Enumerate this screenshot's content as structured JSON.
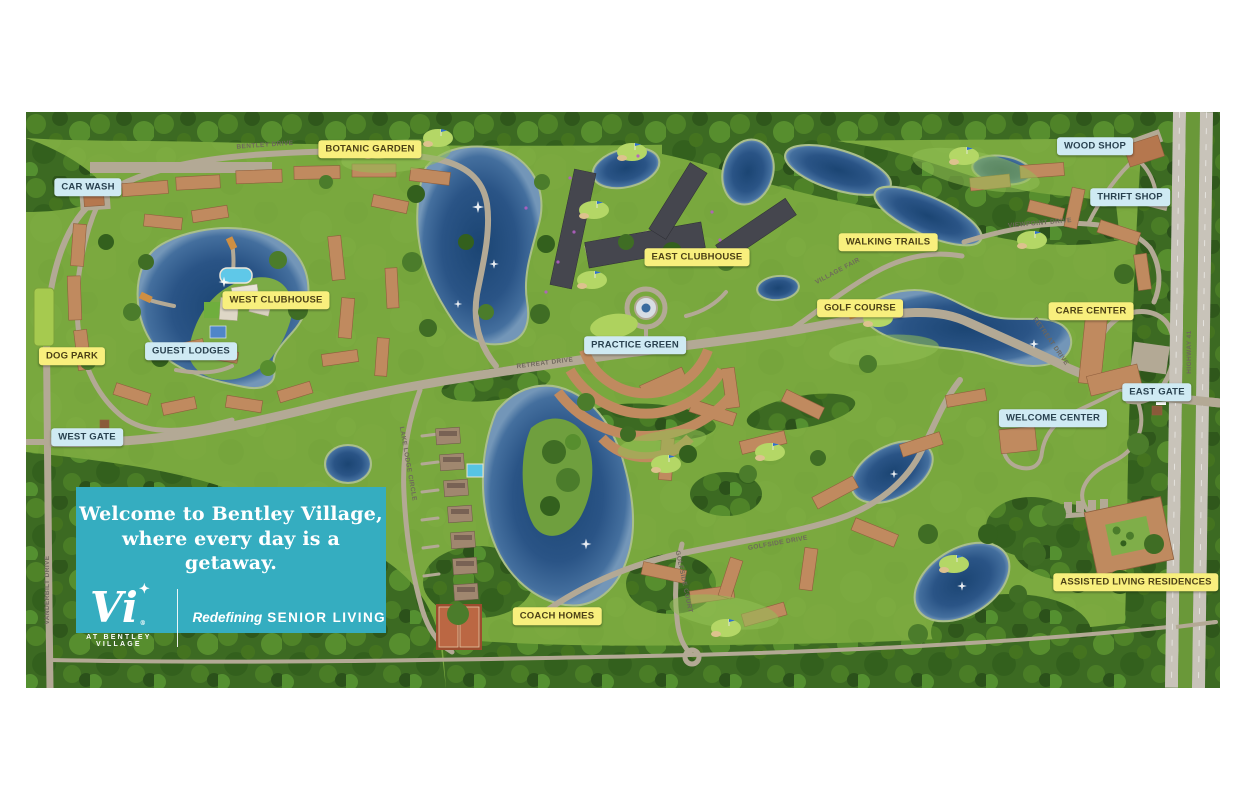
{
  "banner": {
    "headline_line1": "Welcome to Bentley Village,",
    "headline_line2": "where every day is a getaway.",
    "logo_text": "Vi",
    "logo_star": "✦",
    "logo_registered": "®",
    "logo_sub": "AT BENTLEY VILLAGE",
    "tagline_italic": "Redefining",
    "tagline_bold": "SENIOR LIVING"
  },
  "map": {
    "place_labels": [
      {
        "text": "CAR WASH",
        "type": "blue",
        "x": 62,
        "y": 75
      },
      {
        "text": "BOTANIC GARDEN",
        "type": "yellow",
        "x": 344,
        "y": 37
      },
      {
        "text": "WOOD SHOP",
        "type": "blue",
        "x": 1069,
        "y": 34
      },
      {
        "text": "THRIFT SHOP",
        "type": "blue",
        "x": 1104,
        "y": 85
      },
      {
        "text": "WALKING TRAILS",
        "type": "yellow",
        "x": 862,
        "y": 130
      },
      {
        "text": "EAST CLUBHOUSE",
        "type": "yellow",
        "x": 671,
        "y": 145
      },
      {
        "text": "WEST CLUBHOUSE",
        "type": "yellow",
        "x": 250,
        "y": 188
      },
      {
        "text": "GOLF COURSE",
        "type": "yellow",
        "x": 834,
        "y": 196
      },
      {
        "text": "CARE CENTER",
        "type": "yellow",
        "x": 1065,
        "y": 199
      },
      {
        "text": "PRACTICE GREEN",
        "type": "blue",
        "x": 609,
        "y": 233
      },
      {
        "text": "GUEST LODGES",
        "type": "blue",
        "x": 165,
        "y": 239
      },
      {
        "text": "DOG PARK",
        "type": "yellow",
        "x": 46,
        "y": 244
      },
      {
        "text": "EAST GATE",
        "type": "blue",
        "x": 1131,
        "y": 280
      },
      {
        "text": "WELCOME CENTER",
        "type": "blue",
        "x": 1027,
        "y": 306
      },
      {
        "text": "WEST GATE",
        "type": "blue",
        "x": 61,
        "y": 325
      },
      {
        "text": "ASSISTED LIVING RESIDENCES",
        "type": "yellow",
        "x": 1110,
        "y": 470
      },
      {
        "text": "COACH HOMES",
        "type": "yellow",
        "x": 531,
        "y": 504
      }
    ],
    "road_labels": [
      {
        "text": "BENTLEY DRIVE",
        "x": 239,
        "y": 34,
        "rot": -4
      },
      {
        "text": "VANDERBILT DRIVE",
        "x": 22,
        "y": 478,
        "rot": -90
      },
      {
        "text": "RETREAT DRIVE",
        "x": 519,
        "y": 252,
        "rot": -7
      },
      {
        "text": "VILLAGE FAIR",
        "x": 812,
        "y": 160,
        "rot": -28
      },
      {
        "text": "VIEWPOINT DRIVE",
        "x": 1014,
        "y": 112,
        "rot": -5
      },
      {
        "text": "RETREAT DRIVE",
        "x": 1024,
        "y": 230,
        "rot": 55
      },
      {
        "text": "HIGHWAY 41",
        "x": 1164,
        "y": 240,
        "rot": -90
      },
      {
        "text": "GOLFSIDE DRIVE",
        "x": 752,
        "y": 432,
        "rot": -10
      },
      {
        "text": "LAKE LODGE CIRCLE",
        "x": 381,
        "y": 352,
        "rot": 80
      },
      {
        "text": "GOLFSIDE COURT",
        "x": 657,
        "y": 470,
        "rot": 78
      }
    ]
  },
  "colors": {
    "banner_teal": "#35adc0",
    "label_yellow": "#f8ef7d",
    "label_blue": "#cfeaf3",
    "grass_green": "#79a83e",
    "forest_green": "#3c6a22",
    "water_blue": "#2a5486",
    "road_gray": "#b3a995",
    "building_tan": "#c08a5f"
  }
}
